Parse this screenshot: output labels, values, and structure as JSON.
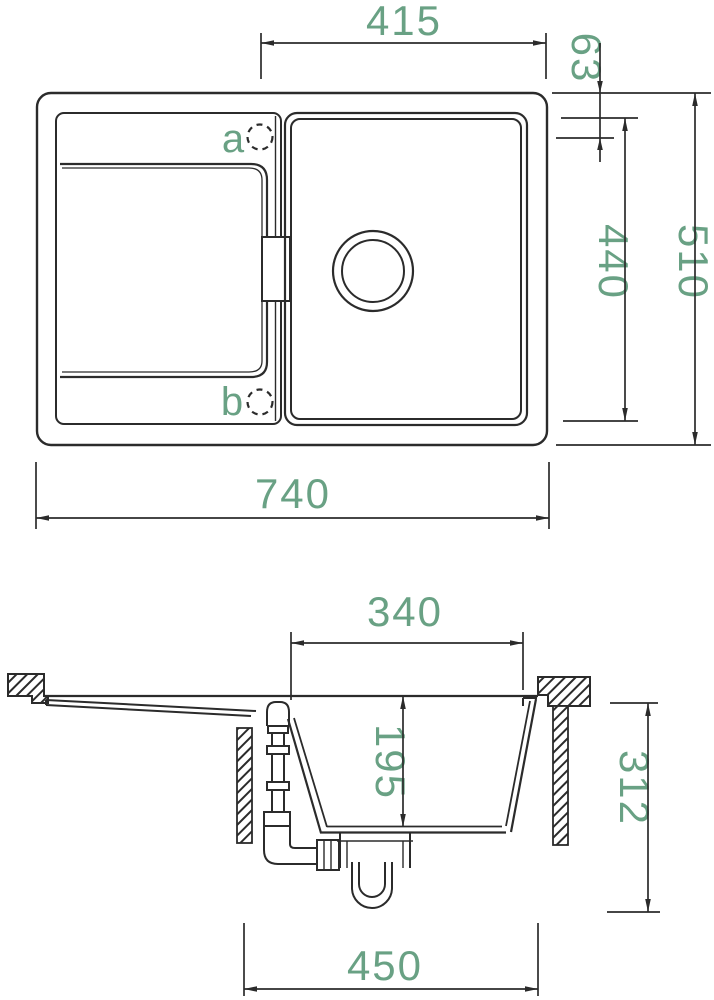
{
  "drawing": {
    "title": "sink-technical-drawing",
    "top_view": {
      "dim_basin_width": "415",
      "dim_hole_offset": "63",
      "dim_bowl_length": "440",
      "dim_overall_depth": "510",
      "dim_overall_width": "740",
      "hole_a_label": "a",
      "hole_b_label": "b"
    },
    "section_view": {
      "dim_bowl_width": "340",
      "dim_bowl_depth": "195",
      "dim_overall_height": "312",
      "dim_cutout_width": "450"
    },
    "colors": {
      "line_color": "#2b2b2b",
      "dim_text_color": "#69a184",
      "background": "#ffffff"
    }
  }
}
